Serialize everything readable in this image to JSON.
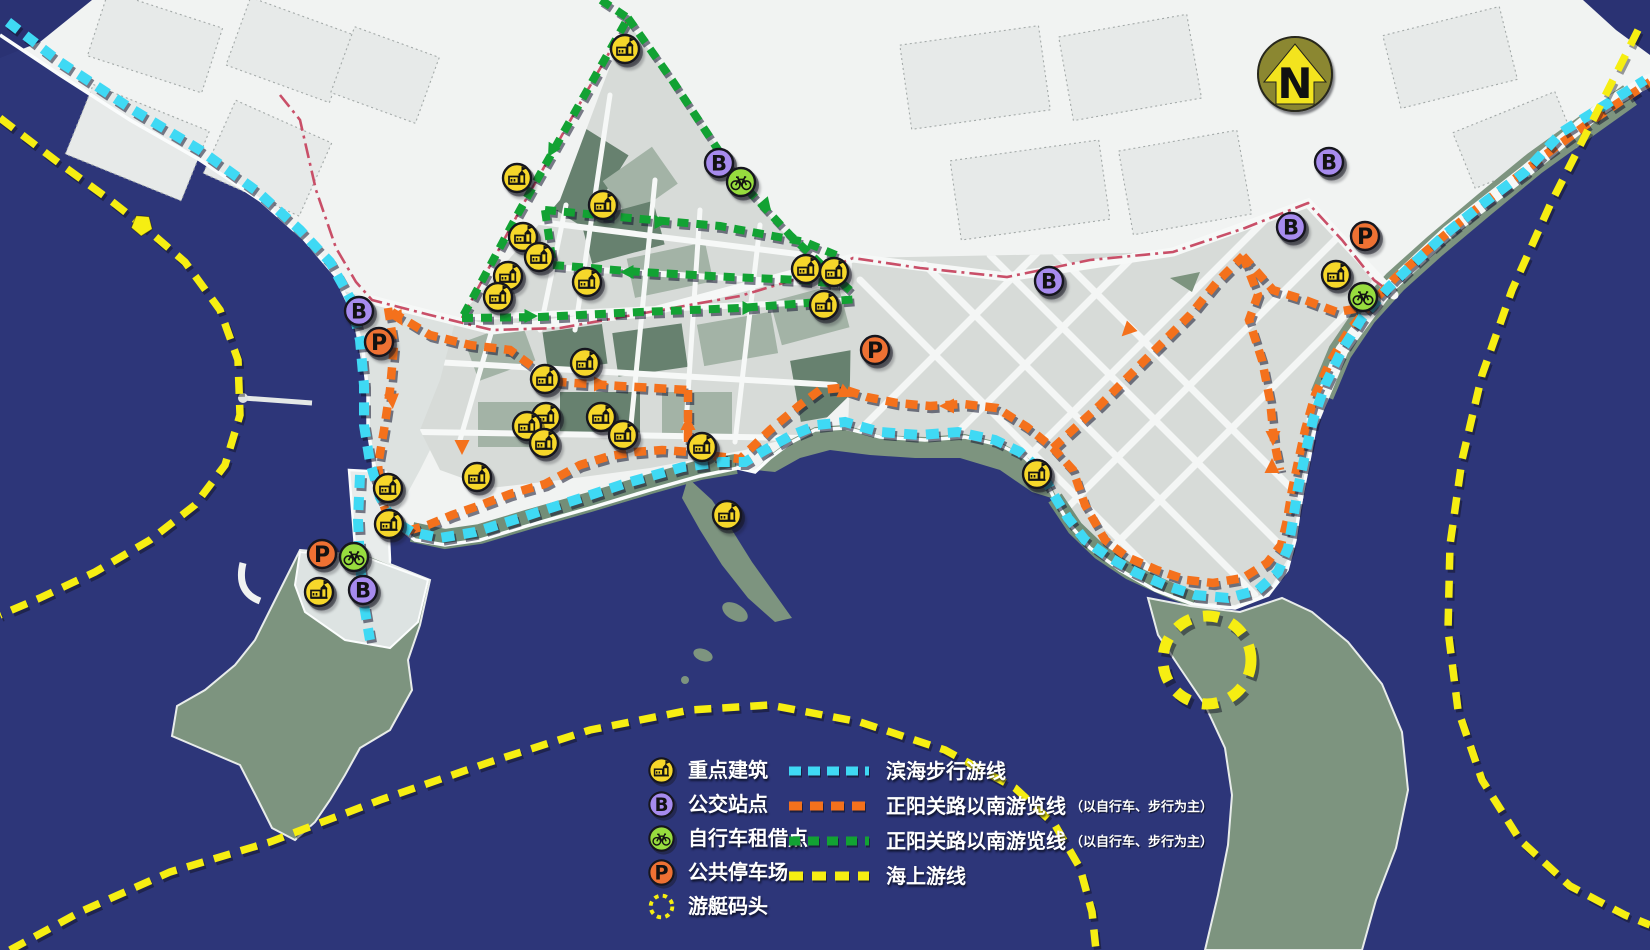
{
  "map": {
    "north_label": "N",
    "colors": {
      "sea": "#2d3679",
      "land": "#f1f3f2",
      "district": "#d7dbd8",
      "vegetation": "#7d947f",
      "coastal_walk_route": "#3fd9f4",
      "south_route_bike": "#f4711c",
      "south_route_green": "#12a233",
      "sea_route": "#f6ee12",
      "road_line": "#c94f68",
      "building_icon": "#f6d72a",
      "bus_icon": "#a78bee",
      "bike_icon": "#97dc3e",
      "parking_icon": "#ee7133"
    },
    "routes": {
      "coastal": {
        "label": "滨海步行游线",
        "color": "#3fd9f4"
      },
      "south_orange": {
        "label": "正阳关路以南游览线",
        "note": "（以自行车、步行为主）",
        "color": "#f4711c"
      },
      "south_green": {
        "label": "正阳关路以南游览线",
        "note": "（以自行车、步行为主）",
        "color": "#12a233"
      },
      "sea": {
        "label": "海上游线",
        "color": "#f6ee12"
      }
    },
    "legend": {
      "points": [
        {
          "icon": "building",
          "label": "重点建筑"
        },
        {
          "icon": "bus",
          "label": "公交站点"
        },
        {
          "icon": "bike",
          "label": "自行车租借点"
        },
        {
          "icon": "parking",
          "label": "公共停车场"
        },
        {
          "icon": "wharf",
          "label": "游艇码头"
        }
      ],
      "lines": [
        {
          "color": "#3fd9f4",
          "dash": "12 7",
          "label": "滨海步行游线",
          "note": ""
        },
        {
          "color": "#f4711c",
          "dash": "13 8",
          "label": "正阳关路以南游览线",
          "note": "（以自行车、步行为主）"
        },
        {
          "color": "#12a233",
          "dash": "11 8",
          "label": "正阳关路以南游览线",
          "note": "（以自行车、步行为主）"
        },
        {
          "color": "#f6ee12",
          "dash": "14 9",
          "label": "海上游线",
          "note": ""
        }
      ]
    },
    "markers": {
      "building": [
        [
          625,
          49
        ],
        [
          517,
          178
        ],
        [
          603,
          205
        ],
        [
          523,
          237
        ],
        [
          539,
          257
        ],
        [
          508,
          276
        ],
        [
          498,
          297
        ],
        [
          587,
          282
        ],
        [
          806,
          269
        ],
        [
          834,
          272
        ],
        [
          824,
          305
        ],
        [
          585,
          363
        ],
        [
          545,
          379
        ],
        [
          546,
          417
        ],
        [
          527,
          426
        ],
        [
          601,
          417
        ],
        [
          544,
          443
        ],
        [
          623,
          435
        ],
        [
          702,
          447
        ],
        [
          477,
          477
        ],
        [
          388,
          488
        ],
        [
          389,
          524
        ],
        [
          727,
          515
        ],
        [
          319,
          592
        ],
        [
          1037,
          474
        ],
        [
          1336,
          275
        ]
      ],
      "bus": [
        [
          719,
          163
        ],
        [
          359,
          311
        ],
        [
          1049,
          281
        ],
        [
          1329,
          162
        ],
        [
          1291,
          227
        ],
        [
          363,
          590
        ]
      ],
      "bike": [
        [
          741,
          182
        ],
        [
          1363,
          297
        ],
        [
          354,
          557
        ]
      ],
      "parking": [
        [
          379,
          342
        ],
        [
          875,
          350
        ],
        [
          1365,
          236
        ],
        [
          322,
          554
        ]
      ]
    },
    "features": {
      "north_arrow": {
        "x": 1295,
        "y": 74
      },
      "yacht_wharf": {
        "x": 1207,
        "y": 660
      },
      "sea_route_star": {
        "x": 142,
        "y": 225
      }
    }
  }
}
